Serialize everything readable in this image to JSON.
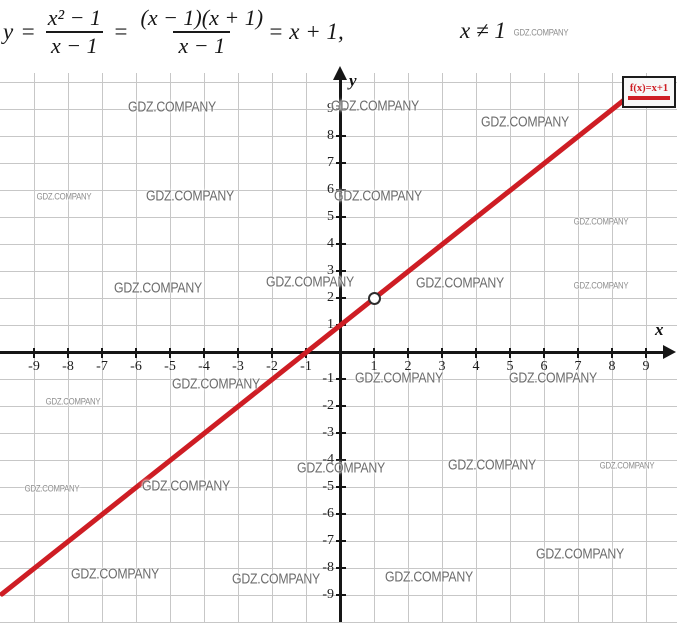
{
  "formula": {
    "lhs": "y",
    "eq1": "=",
    "frac1": {
      "num": "x² − 1",
      "den": "x − 1"
    },
    "eq2": "=",
    "frac2": {
      "num": "(x − 1)(x + 1)",
      "den": "x − 1"
    },
    "tail": "= x + 1,",
    "condition": "x ≠ 1"
  },
  "chart_data": {
    "type": "line",
    "title": "y = (x² − 1)/(x − 1) = (x − 1)(x + 1)/(x − 1) = x + 1, x ≠ 1",
    "xlabel": "x",
    "ylabel": "y",
    "xlim": [
      -10,
      10
    ],
    "ylim": [
      -10,
      10
    ],
    "grid": true,
    "x_ticks": [
      -9,
      -8,
      -7,
      -6,
      -5,
      -4,
      -3,
      -2,
      -1,
      1,
      2,
      3,
      4,
      5,
      6,
      7,
      8,
      9
    ],
    "y_ticks": [
      9,
      8,
      7,
      6,
      5,
      4,
      3,
      2,
      1,
      -1,
      -2,
      -3,
      -4,
      -5,
      -6,
      -7,
      -8,
      -9
    ],
    "legend": {
      "label": "f(x)=x+1",
      "position": "top-right"
    },
    "series": [
      {
        "name": "f(x)=x+1",
        "equation": "y = x + 1",
        "color": "#ce1d24",
        "points": [
          [
            -10,
            -9
          ],
          [
            9,
            10
          ]
        ]
      }
    ],
    "open_point": {
      "x": 1,
      "y": 2
    }
  },
  "watermarks": {
    "text": "GDZ.COMPANY",
    "items": [
      {
        "x": 541,
        "y": 33,
        "size": "sm"
      },
      {
        "x": 172,
        "y": 107,
        "size": "lg"
      },
      {
        "x": 375,
        "y": 106,
        "size": "lg"
      },
      {
        "x": 525,
        "y": 122,
        "size": "lg"
      },
      {
        "x": 64,
        "y": 197,
        "size": "sm"
      },
      {
        "x": 190,
        "y": 196,
        "size": "lg"
      },
      {
        "x": 378,
        "y": 196,
        "size": "lg"
      },
      {
        "x": 601,
        "y": 222,
        "size": "sm"
      },
      {
        "x": 158,
        "y": 288,
        "size": "lg"
      },
      {
        "x": 310,
        "y": 282,
        "size": "lg"
      },
      {
        "x": 460,
        "y": 283,
        "size": "lg"
      },
      {
        "x": 601,
        "y": 286,
        "size": "sm"
      },
      {
        "x": 216,
        "y": 384,
        "size": "lg"
      },
      {
        "x": 399,
        "y": 378,
        "size": "lg"
      },
      {
        "x": 553,
        "y": 378,
        "size": "lg"
      },
      {
        "x": 73,
        "y": 402,
        "size": "sm"
      },
      {
        "x": 341,
        "y": 468,
        "size": "lg"
      },
      {
        "x": 492,
        "y": 465,
        "size": "lg"
      },
      {
        "x": 627,
        "y": 466,
        "size": "sm"
      },
      {
        "x": 52,
        "y": 489,
        "size": "sm"
      },
      {
        "x": 186,
        "y": 486,
        "size": "lg"
      },
      {
        "x": 580,
        "y": 554,
        "size": "lg"
      },
      {
        "x": 115,
        "y": 574,
        "size": "lg"
      },
      {
        "x": 276,
        "y": 579,
        "size": "lg"
      },
      {
        "x": 429,
        "y": 577,
        "size": "lg"
      }
    ]
  },
  "colors": {
    "line": "#ce1d24",
    "axis": "#161616",
    "grid": "#c7c7c7",
    "tick_label": "#1d1d1d",
    "watermark": "#6c6c6c",
    "legend_border": "#1c1c1c",
    "legend_bg": "#f7f7f7"
  }
}
